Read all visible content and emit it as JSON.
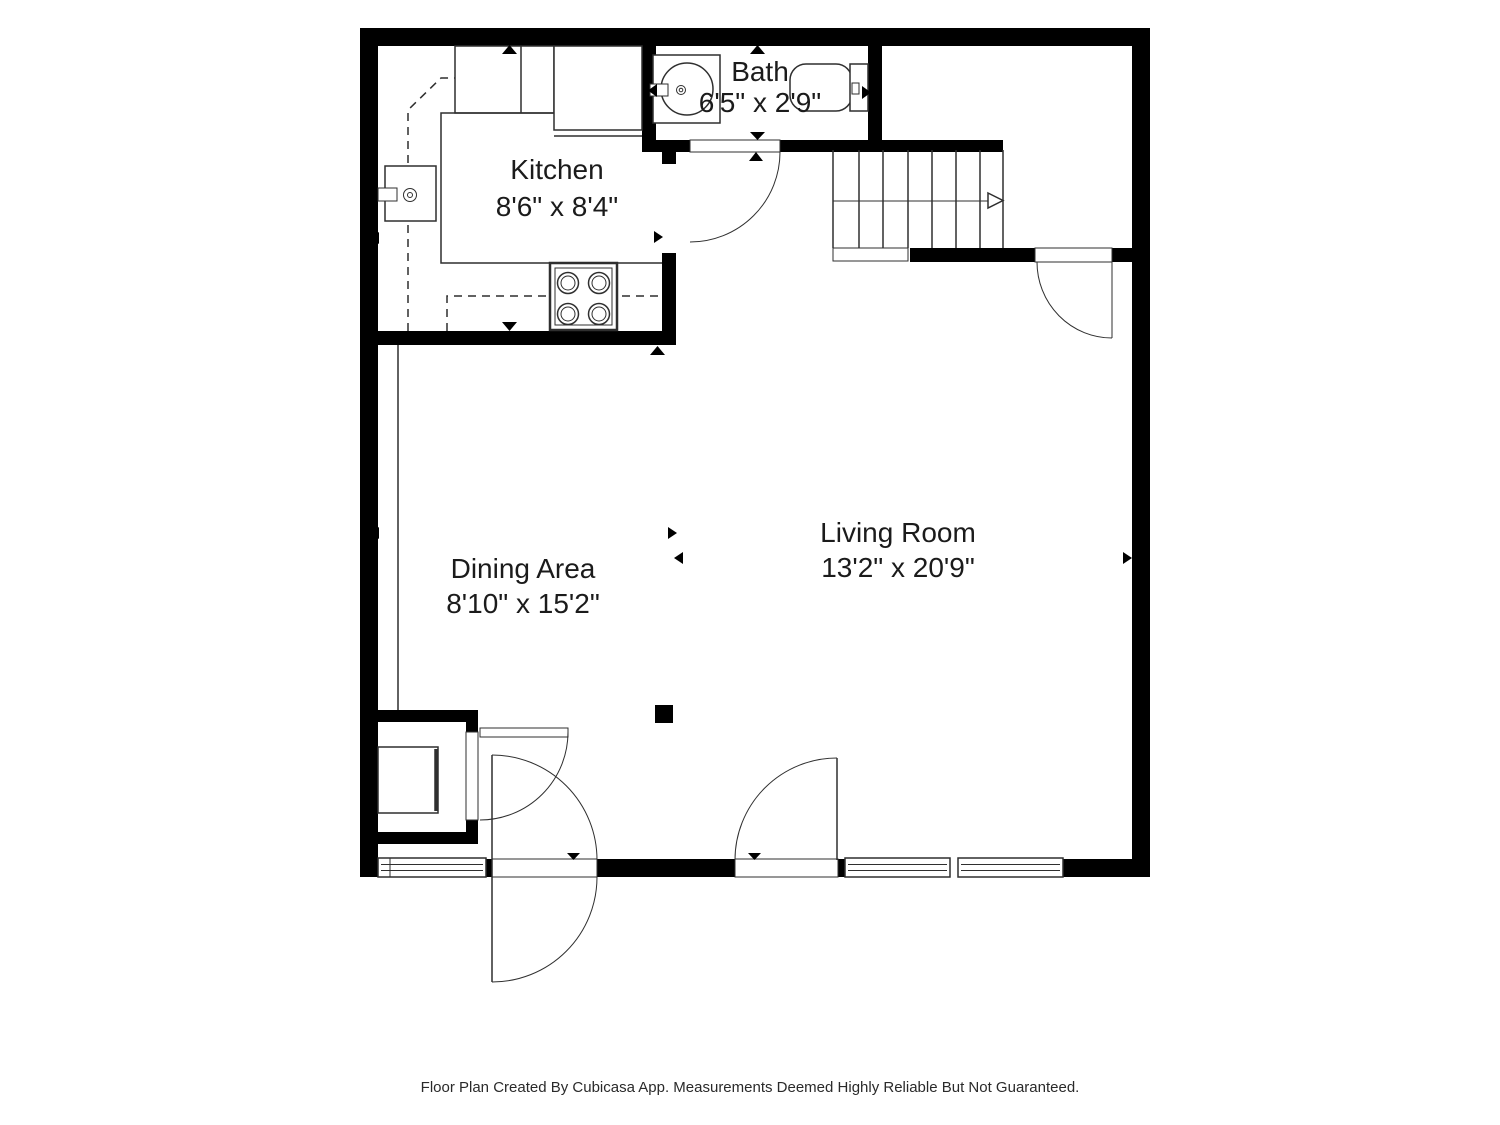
{
  "plan": {
    "rooms": [
      {
        "name": "Bath",
        "dims": "6'5\" x 2'9\""
      },
      {
        "name": "Kitchen",
        "dims": "8'6\" x 8'4\""
      },
      {
        "name": "Dining Area",
        "dims": "8'10\" x 15'2\""
      },
      {
        "name": "Living Room",
        "dims": "13'2\" x 20'9\""
      }
    ],
    "fixtures": [
      "stairs",
      "bath-sink",
      "toilet",
      "kitchen-sink",
      "stove",
      "washer",
      "entry-door",
      "windows"
    ],
    "colors": {
      "wall": "#000000",
      "line": "#2f2f2f",
      "background": "#ffffff",
      "text": "#1b1b1b"
    }
  },
  "footer": {
    "note": "Floor Plan Created By Cubicasa App. Measurements Deemed Highly Reliable But Not Guaranteed."
  }
}
